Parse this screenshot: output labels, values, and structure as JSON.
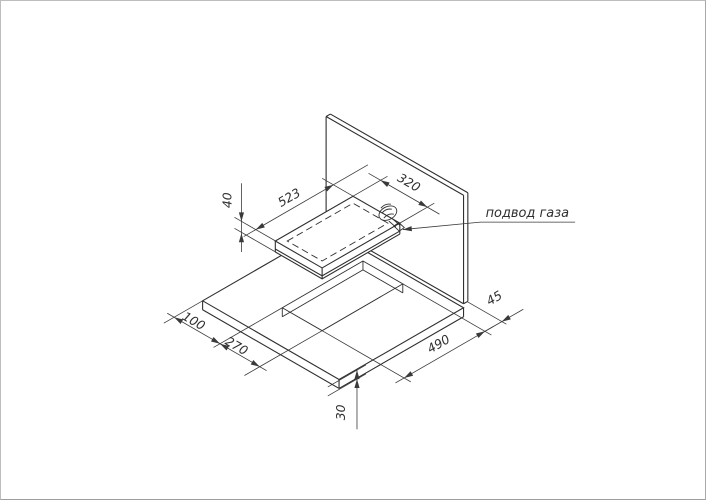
{
  "drawing": {
    "type": "isometric installation drawing: gas hob, worktop cutout and back wall",
    "callout": {
      "label": "подвод газа"
    },
    "dimensions": {
      "hob_length": "523",
      "hob_depth": "320",
      "hob_thickness": "40",
      "left_edge_to_cutout": "100",
      "cutout_depth": "270",
      "cutout_length": "490",
      "cutout_to_wall": "45",
      "worktop_thickness": "30"
    },
    "colors": {
      "line_color": "#2f2f2f",
      "dimension_color": "#3a3a3a",
      "background": "#ffffff",
      "page_border": "#bdbdbd"
    }
  }
}
